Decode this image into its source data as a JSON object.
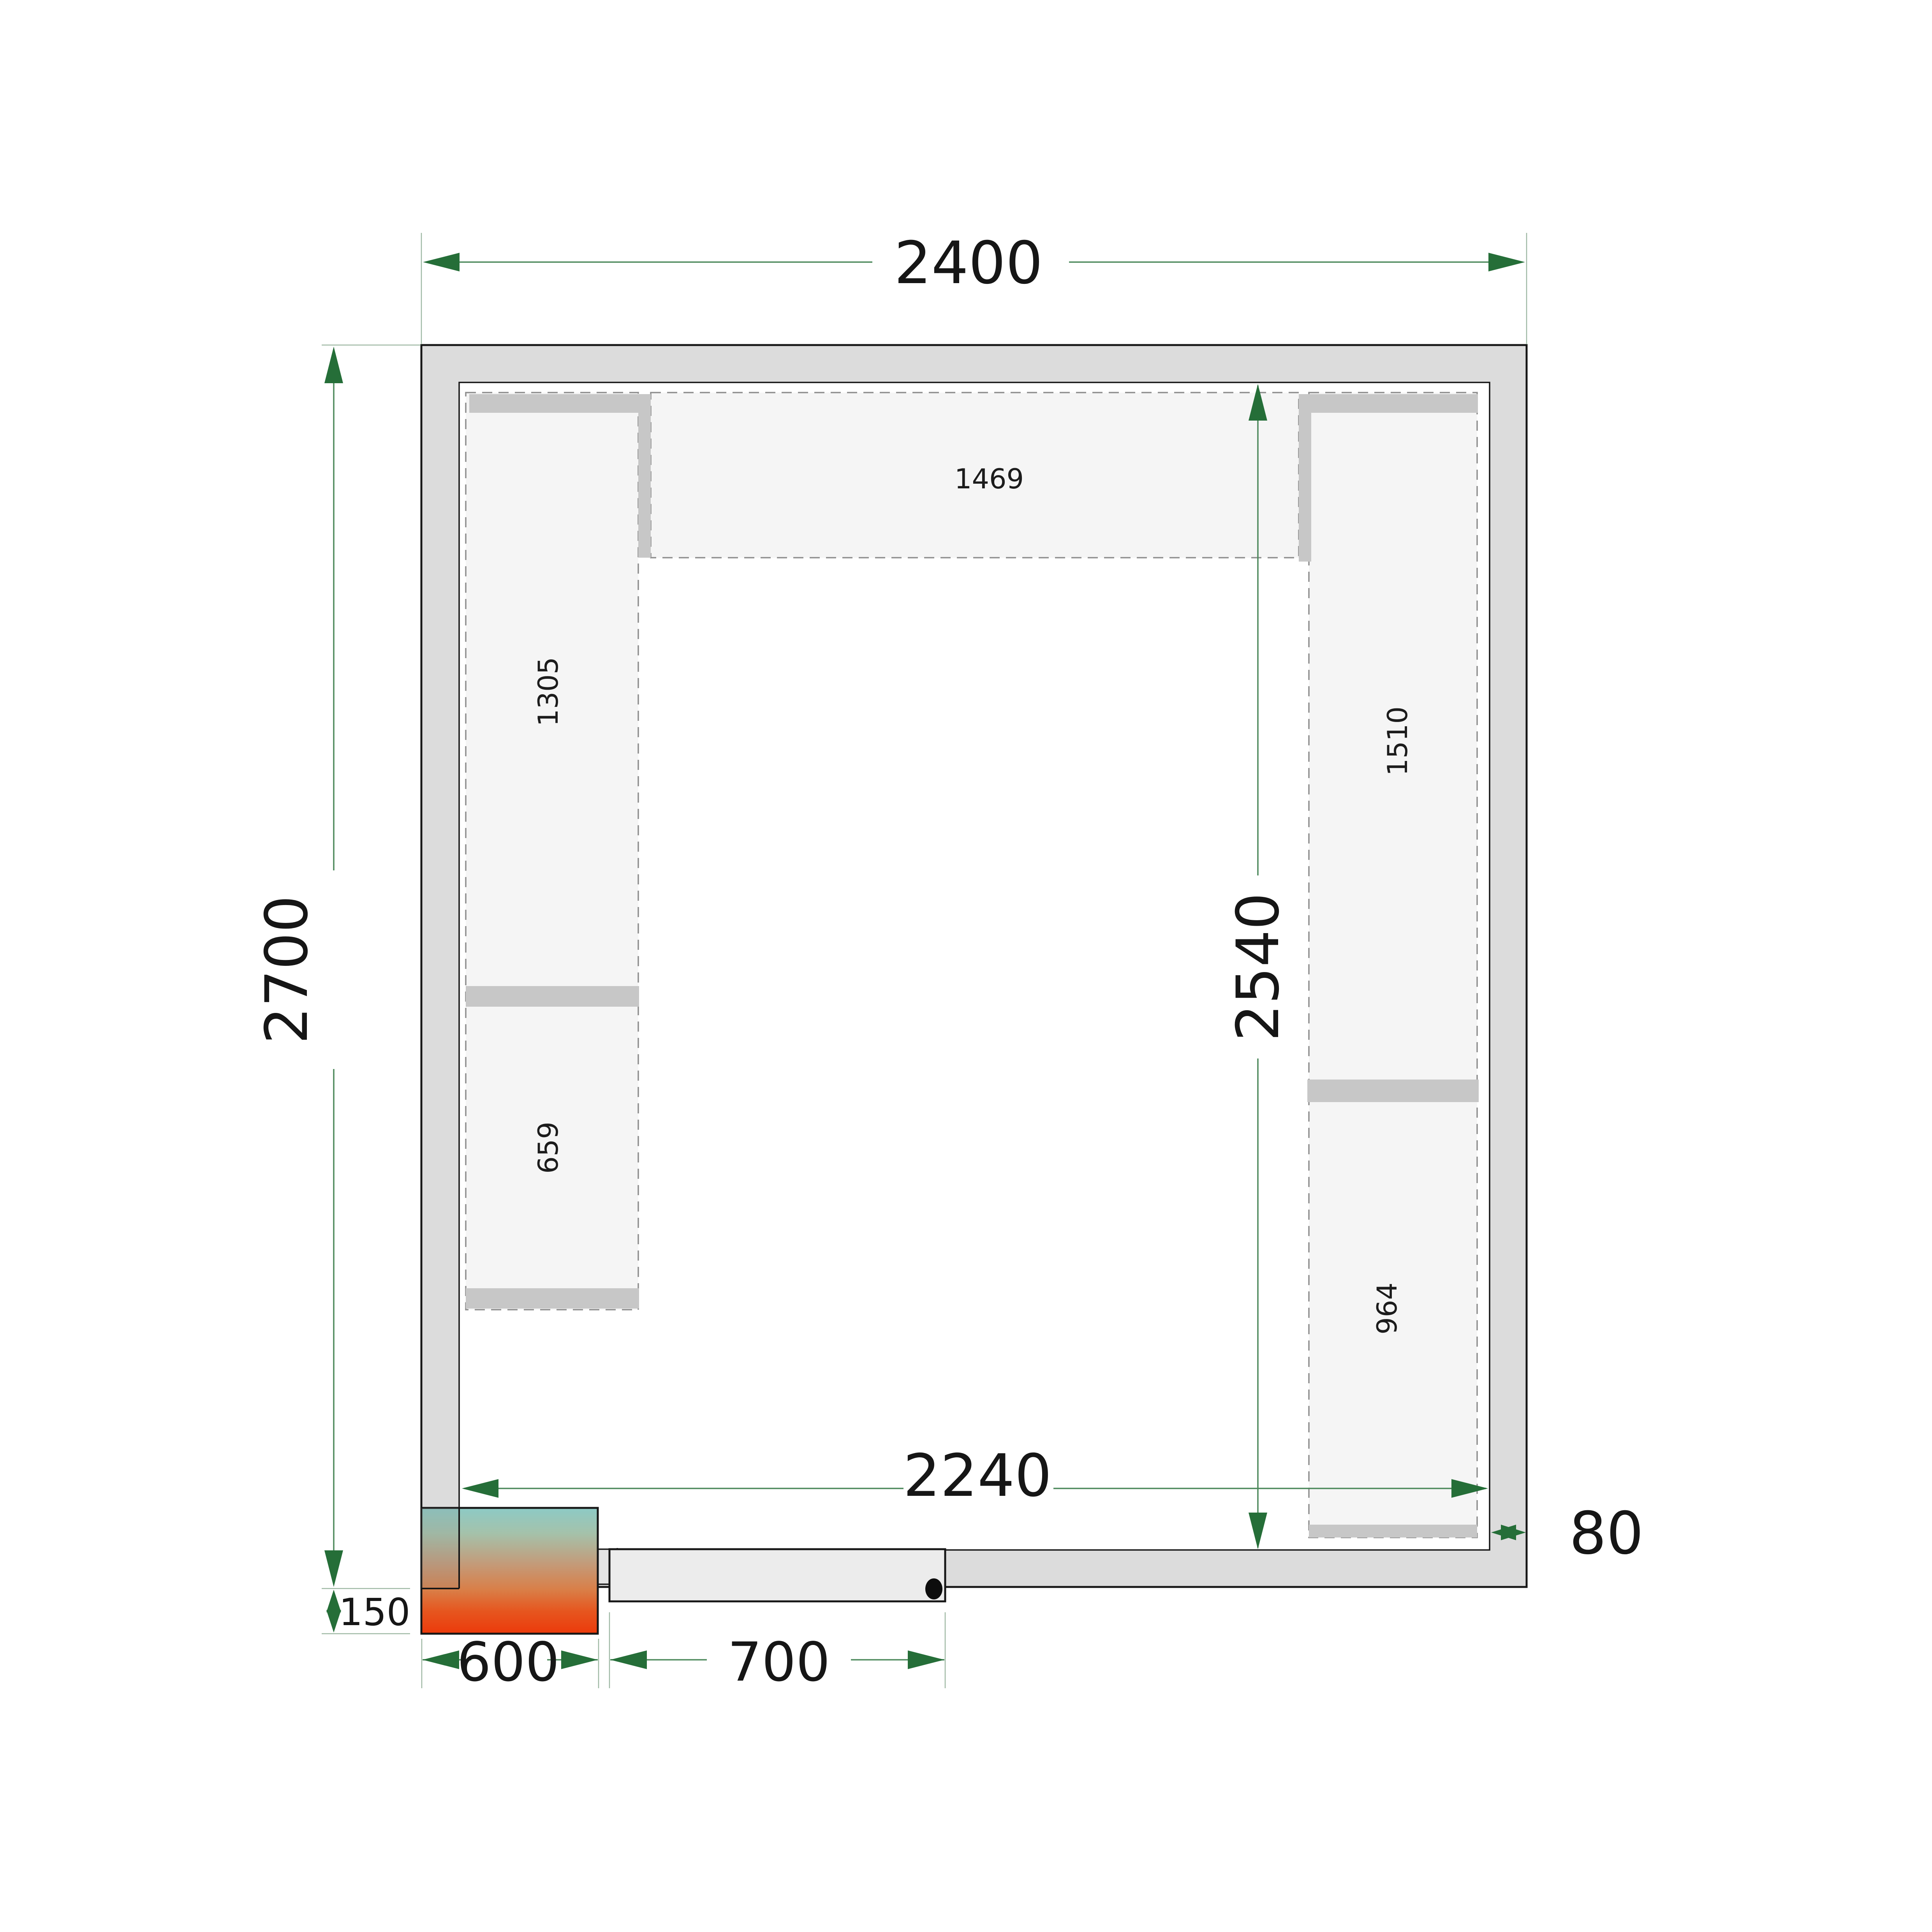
{
  "drawing": {
    "type": "cold-room floor plan",
    "dimensions": {
      "overall_width": "2400",
      "overall_height": "2700",
      "inner_width": "2240",
      "inner_height": "2540",
      "wall_thickness": "80",
      "unit_protrusion": "150",
      "unit_width": "600",
      "door_width": "700"
    },
    "shelves": {
      "top": "1469",
      "left_upper": "1305",
      "left_lower": "659",
      "right_upper": "1510",
      "right_lower": "964"
    },
    "colors": {
      "wall_fill": "#dcdcdc",
      "room_fill": "#ffffff",
      "shelf_fill": "#f5f5f5",
      "shelf_support": "#c7c7c7",
      "shelf_dash": "#8f8f8f",
      "dimension_line_green": "#4e8a5d",
      "extension_line_green": "#9db7a2",
      "arrow_green": "#256e38",
      "door_fill": "#ececec",
      "unit_gradient_top": "#8dcac5",
      "unit_gradient_mid": "#c49a78",
      "unit_gradient_bottom": "#ec3a0b",
      "outline_black": "#161616"
    }
  }
}
